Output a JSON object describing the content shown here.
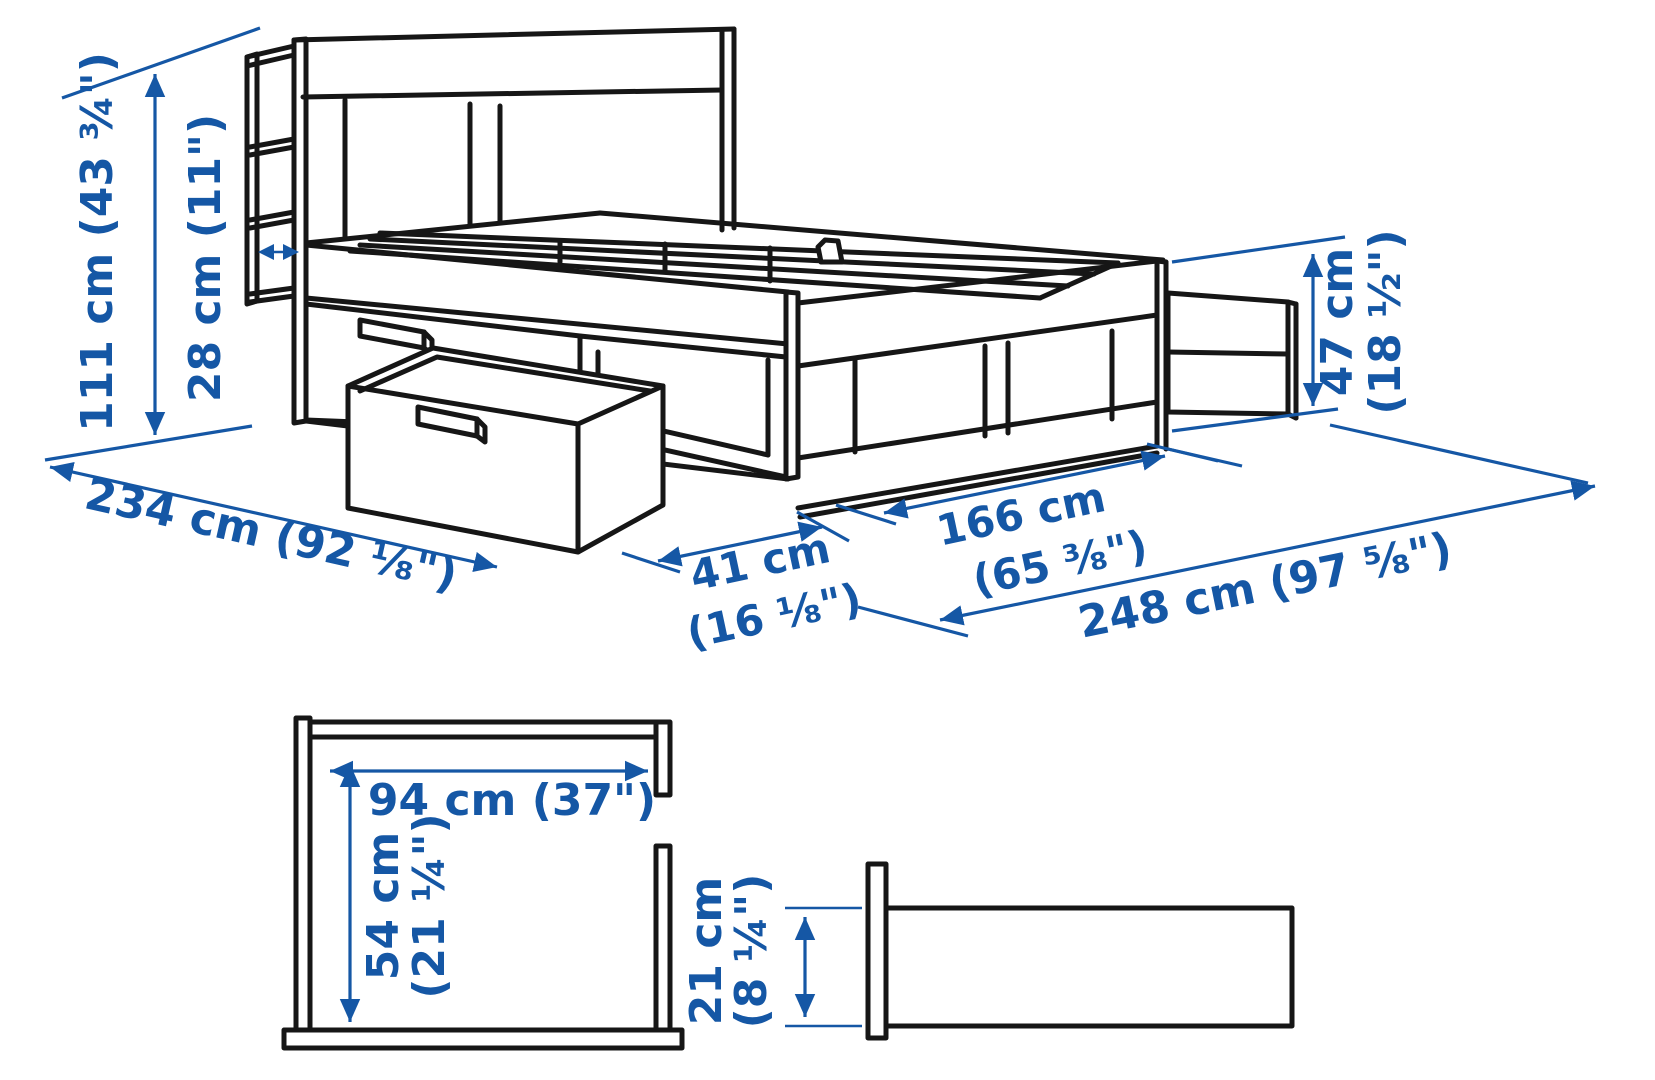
{
  "figure": {
    "kind": "product-dimension-diagram",
    "subject": "bed frame with headboard storage, underbed drawers and shelf headboard"
  },
  "colors": {
    "dimension_blue": "#1557A5",
    "line_black": "#161616",
    "background": "#ffffff"
  },
  "dims": {
    "total_height": "111 cm (43 ¾\")",
    "headboard_storage_depth": "28 cm (11\")",
    "underbed_drawer_height_cm": "47 cm",
    "underbed_drawer_height_in": "(18 ½\")",
    "total_length": "234 cm (92 ⅛\")",
    "drawer_pullout_cm": "41 cm",
    "drawer_pullout_in": "(16 ⅛\")",
    "frame_section_cm": "166 cm",
    "frame_section_in": "(65 ⅜\")",
    "extended_total_length": "248 cm (97 ⅝\")",
    "headboard_opening_width": "94 cm (37\")",
    "headboard_opening_height_cm": "54 cm",
    "headboard_opening_height_in": "(21 ¼\")",
    "shelf_depth_cm": "21 cm",
    "shelf_depth_in": "(8 ¼\")"
  }
}
